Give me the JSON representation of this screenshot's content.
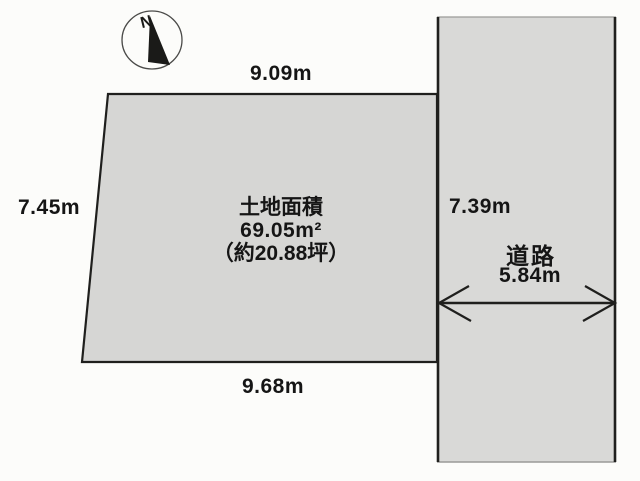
{
  "diagram_title": "土地区画図",
  "colors": {
    "background": "#fcfcfa",
    "plot_fill": "#d6d6d4",
    "road_fill": "#d9d9d7",
    "line": "#1f1f1d",
    "thin_edge": "#9a9a98",
    "text": "#151515"
  },
  "compass": {
    "label": "N"
  },
  "plot": {
    "area_title": "土地面積",
    "area_value": "69.05m²",
    "area_tsubo": "（約20.88坪）",
    "dimensions": {
      "top": "9.09m",
      "left": "7.45m",
      "right": "7.39m",
      "bottom": "9.68m"
    }
  },
  "road": {
    "name": "道路",
    "width": "5.84m"
  }
}
